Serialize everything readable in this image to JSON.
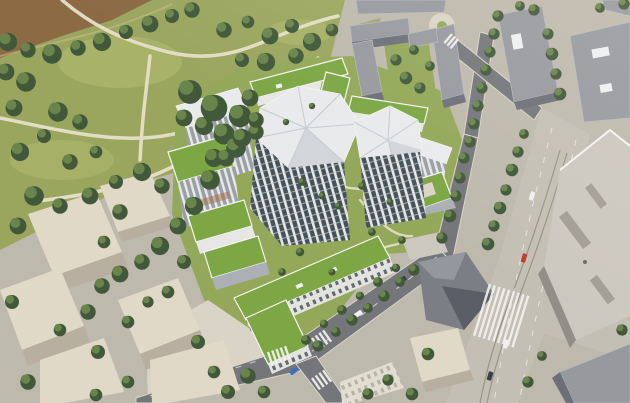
{
  "scene": {
    "title": "Aerial architectural rendering of a residential quarter with green roofs beside a riverside park",
    "alt": "Bird's-eye rendering: a park with mature trees, lawns and winding light paths with a brown river bank in the upper left; in the center a new residential development of white mid-rise blocks with planted green roofs and two faceted white-roofed towers around leafy courtyards; existing grey apartment slabs at the top right; beige hip-roofed blocks at the lower left; tree-lined streets, a junction with zebra crossings and a blue car at the bottom center; a wide boulevard with tram tracks, a large pedestrian crossing and big flat-roofed buildings on the right.",
    "visible_features": [
      "riverside park with trees and paths",
      "river bank water",
      "green-roof residential blocks",
      "faceted white roof towers",
      "existing grey housing slabs",
      "beige hip-roofed buildings",
      "tree-lined streets",
      "boulevard with tram tracks",
      "zebra pedestrian crossings",
      "cars including one blue car"
    ],
    "palette": {
      "grass": "#9aa65e",
      "grass_light": "#b6bd74",
      "lawn": "#93a859",
      "tree_dark": "#41583a",
      "tree_light": "#69854c",
      "water": "#8b6a44",
      "path": "#e6e0ca",
      "paving": "#beb9ad",
      "paving_bright": "#d9d4c6",
      "road": "#74767a",
      "road_dark": "#606266",
      "boulevard": "#c4bfb4",
      "track": "#94907f",
      "marking": "#f2f2ee",
      "green_roof": "#7ca744",
      "green_roof_dark": "#61893a",
      "white_roof": "#e8eaec",
      "white_roof_shade": "#d2d6da",
      "facade_light": "#e6e7e4",
      "facade_shade": "#aab0b6",
      "glass": "#46525a",
      "parapet": "#f4f4f0",
      "gray_roof": "#97999f",
      "gray_facade": "#6c6f78",
      "beige_roof": "#e0d9c8",
      "beige_facade": "#b8afa0",
      "big_roof": "#ccc7bf",
      "big_roof_facade": "#928e87",
      "dark_bldg": "#7b7e85",
      "dark_bldg_dark": "#5a5e66",
      "dark_bldg_light": "#94979d",
      "car_blue": "#3c6fc2",
      "car_red": "#c03b30",
      "car_white": "#eff0f0",
      "car_dark": "#3a3e45"
    }
  }
}
